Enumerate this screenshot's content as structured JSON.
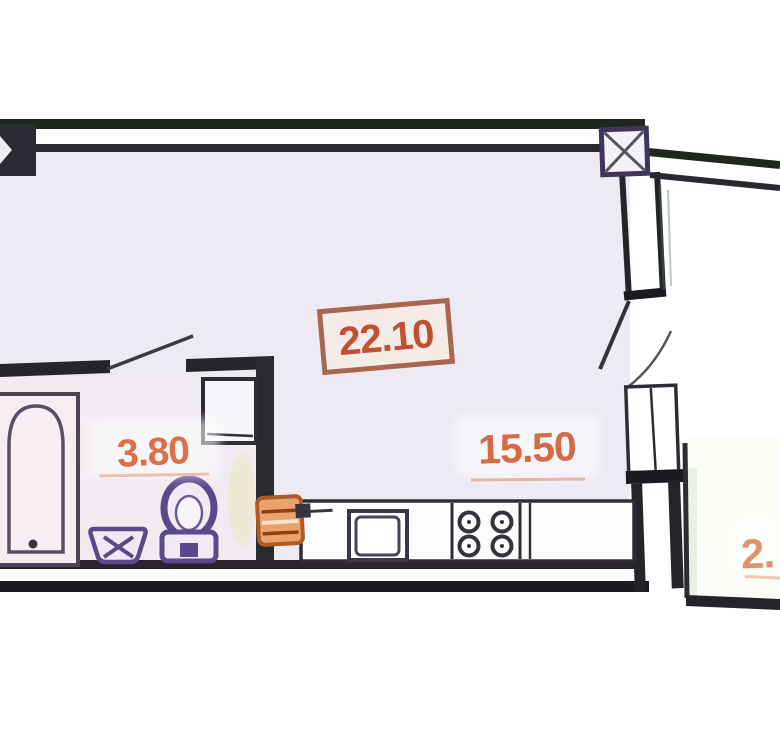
{
  "title": "apartment-floor-plan",
  "labels": {
    "main_area": "22.10",
    "kitchen_area": "15.50",
    "bath_area": "3.80",
    "balcony_area": "2."
  },
  "colors": {
    "wall": "#25242b",
    "fixture_purple": "#5a4a8c",
    "area_text_orange": "#d2603f",
    "area_box_border": "#9e4f33",
    "boiler_orange": "#b05a24",
    "room_fill": "#edeaf3",
    "hatch_green": "#44663f"
  },
  "fixtures": [
    "bathtub",
    "toilet",
    "bathroom-sink",
    "kitchen-counter",
    "kitchen-sink",
    "stove-4-burners",
    "boiler",
    "column-marker",
    "window",
    "balcony-door",
    "door-swing"
  ]
}
